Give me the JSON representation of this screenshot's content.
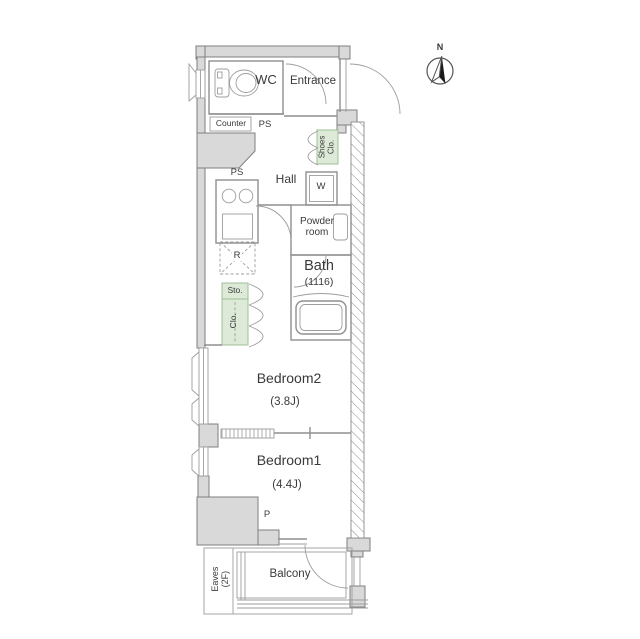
{
  "meta": {
    "type": "apartment-floor-plan"
  },
  "colors": {
    "wall_fill": "#d9d9d9",
    "outline": "#8f8f8f",
    "closet_fill": "#dcead7",
    "closet_border": "#a0bf98",
    "text": "#3a3a3a"
  },
  "compass": {
    "label": "N"
  },
  "labels": {
    "wc": "WC",
    "entrance": "Entrance",
    "counter": "Counter",
    "ps_upper": "PS",
    "ps_lower": "PS",
    "shoes_closet": "Shoes Clo.",
    "hall": "Hall",
    "washer": "W",
    "powder_room": "Powder room",
    "bath": "Bath",
    "bath_size": "(1116)",
    "refrigerator": "R",
    "storage": "Sto.",
    "closet": "Clo.",
    "bedroom2": "Bedroom2",
    "bedroom2_size": "(3.8J)",
    "bedroom1": "Bedroom1",
    "bedroom1_size": "(4.4J)",
    "pipe_space_p": "P",
    "balcony": "Balcony",
    "eaves_line1": "Eaves",
    "eaves_line2": "(2F)"
  }
}
